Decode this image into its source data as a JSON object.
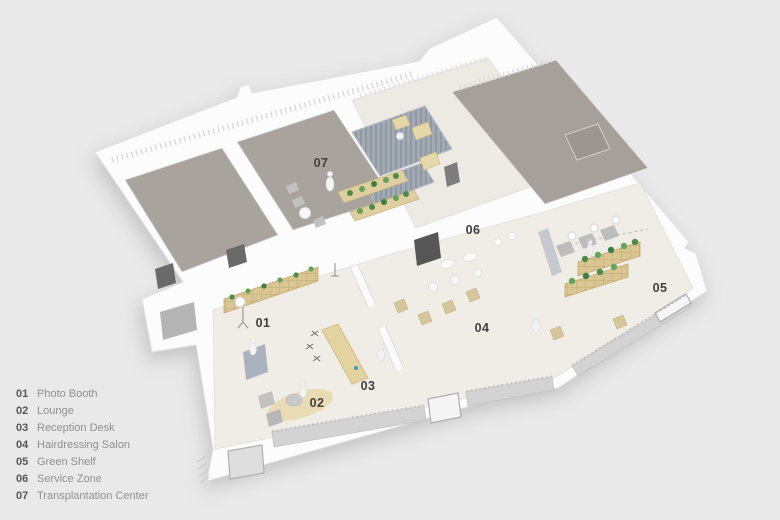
{
  "rooms": [
    {
      "number": "01",
      "label": "Photo Booth"
    },
    {
      "number": "02",
      "label": "Lounge"
    },
    {
      "number": "03",
      "label": "Reception Desk"
    },
    {
      "number": "04",
      "label": "Hairdressing Salon"
    },
    {
      "number": "05",
      "label": "Green Shelf"
    },
    {
      "number": "06",
      "label": "Service Zone"
    },
    {
      "number": "07",
      "label": "Transplantation Center"
    }
  ],
  "colors": {
    "background": "#e9e9e9",
    "marker_text": "#3f3f3f",
    "legend_number": "#565656",
    "legend_label": "#8f8f8f",
    "floor_light": "#f0ede6",
    "floor_gray": "#a8a49d",
    "wood_beige": "#dbc693",
    "plant_green": "#4e8a4a",
    "curtain_gray": "#9ca4ae",
    "glass_gray": "#d3d3d3",
    "wall_white": "#fcfcfc"
  }
}
